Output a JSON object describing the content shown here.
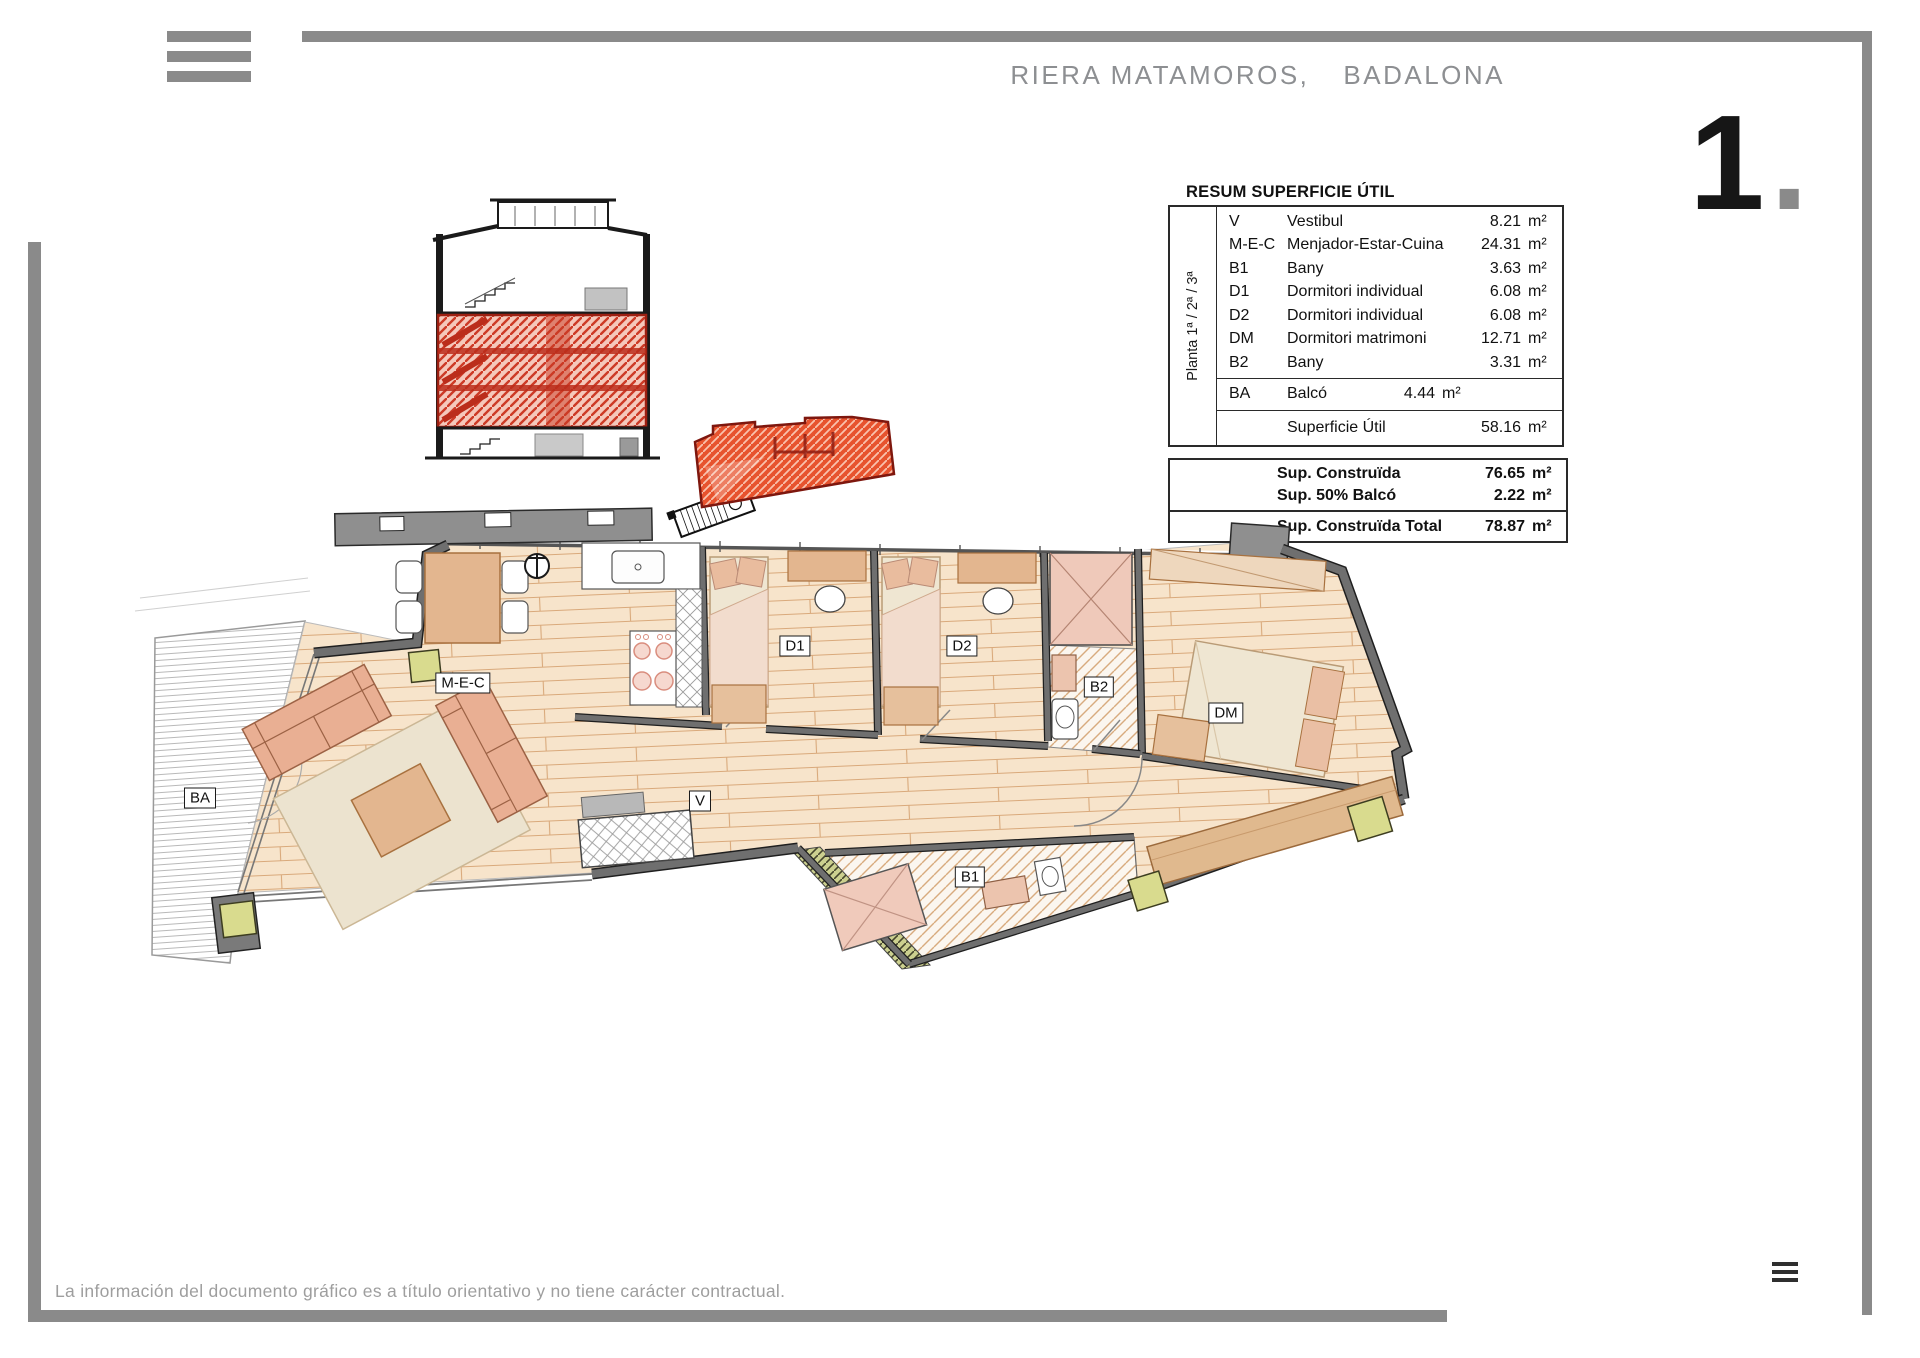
{
  "header": {
    "location": "RIERA MATAMOROS,",
    "city": "BADALONA",
    "sheet_number": "1",
    "sheet_number_dot": ".",
    "menu_icon": "hamburger-menu"
  },
  "area_table": {
    "title": "RESUM SUPERFICIE ÚTIL",
    "floor_label": "Planta 1ª / 2ª / 3ª",
    "rows": [
      {
        "code": "V",
        "name": "Vestibul",
        "value": "8.21",
        "unit": "m²"
      },
      {
        "code": "M-E-C",
        "name": "Menjador-Estar-Cuina",
        "value": "24.31",
        "unit": "m²"
      },
      {
        "code": "B1",
        "name": "Bany",
        "value": "3.63",
        "unit": "m²"
      },
      {
        "code": "D1",
        "name": "Dormitori individual",
        "value": "6.08",
        "unit": "m²"
      },
      {
        "code": "D2",
        "name": "Dormitori individual",
        "value": "6.08",
        "unit": "m²"
      },
      {
        "code": "DM",
        "name": "Dormitori matrimoni",
        "value": "12.71",
        "unit": "m²"
      },
      {
        "code": "B2",
        "name": "Bany",
        "value": "3.31",
        "unit": "m²"
      }
    ],
    "balcony_row": {
      "code": "BA",
      "name": "Balcó",
      "value": "4.44",
      "unit": "m²"
    },
    "total_row": {
      "name": "Superficie Útil",
      "value": "58.16",
      "unit": "m²"
    }
  },
  "built_table": {
    "rows": [
      {
        "name": "Sup. Construïda",
        "value": "76.65",
        "unit": "m²"
      },
      {
        "name": "Sup. 50% Balcó",
        "value": "2.22",
        "unit": "m²"
      },
      {
        "name": "Sup. Construïda Total",
        "value": "78.87",
        "unit": "m²"
      }
    ]
  },
  "floor_plan": {
    "labels": {
      "ba": "BA",
      "mec": "M-E-C",
      "d1": "D1",
      "d2": "D2",
      "b2": "B2",
      "dm": "DM",
      "v": "V",
      "b1": "B1"
    }
  },
  "footer": {
    "disclaimer": "La información del documento gráfico es a título orientativo y no tiene carácter contractual.",
    "menu_icon": "hamburger-menu"
  },
  "colors": {
    "frame_gray": "#8a8a8a",
    "header_text": "#8d8f92",
    "highlight_red": "#cd3a26",
    "site_red": "#e7532e",
    "wood_floor": "#f7e4cb",
    "wood_line": "#d9a97b",
    "wall_gray": "#6f6f6f",
    "furniture_tan": "#e3b68f",
    "sofa_salmon": "#e9af93",
    "rug_cream": "#ece3cf",
    "pillar_green": "#d9db8e"
  }
}
